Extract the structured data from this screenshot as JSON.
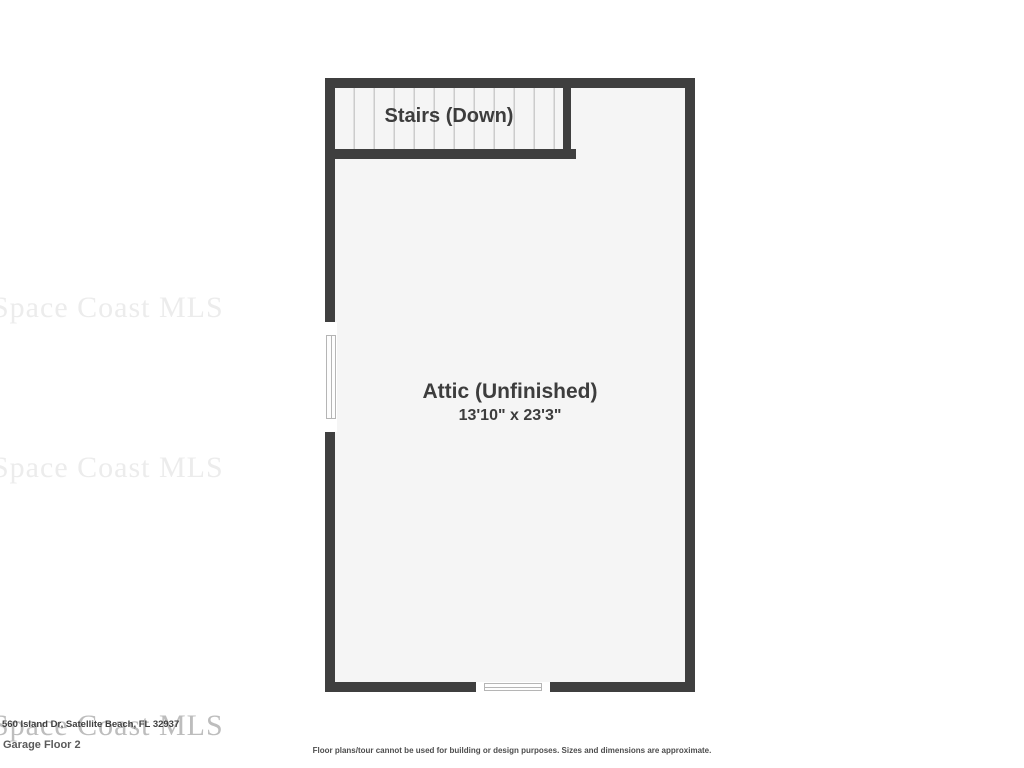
{
  "floorplan": {
    "stairs_label": "Stairs (Down)",
    "room_label": "Attic (Unfinished)",
    "room_dimensions": "13'10\" x 23'3\"",
    "wall_color": "#3f3f3f",
    "floor_color": "#f5f5f5",
    "tread_line_color": "#cccccc",
    "window_line_color": "#b5b5b5",
    "label_color": "#3d3d3d"
  },
  "watermark": {
    "text": "Space Coast MLS",
    "faint_color": "#ececec",
    "footer_color": "#bdbdbd"
  },
  "footer": {
    "address": "560 Island Dr, Satellite Beach, FL 32937",
    "floor_label": "Garage Floor 2",
    "disclaimer": "Floor plans/tour cannot be used for building or design purposes. Sizes and dimensions are approximate."
  }
}
